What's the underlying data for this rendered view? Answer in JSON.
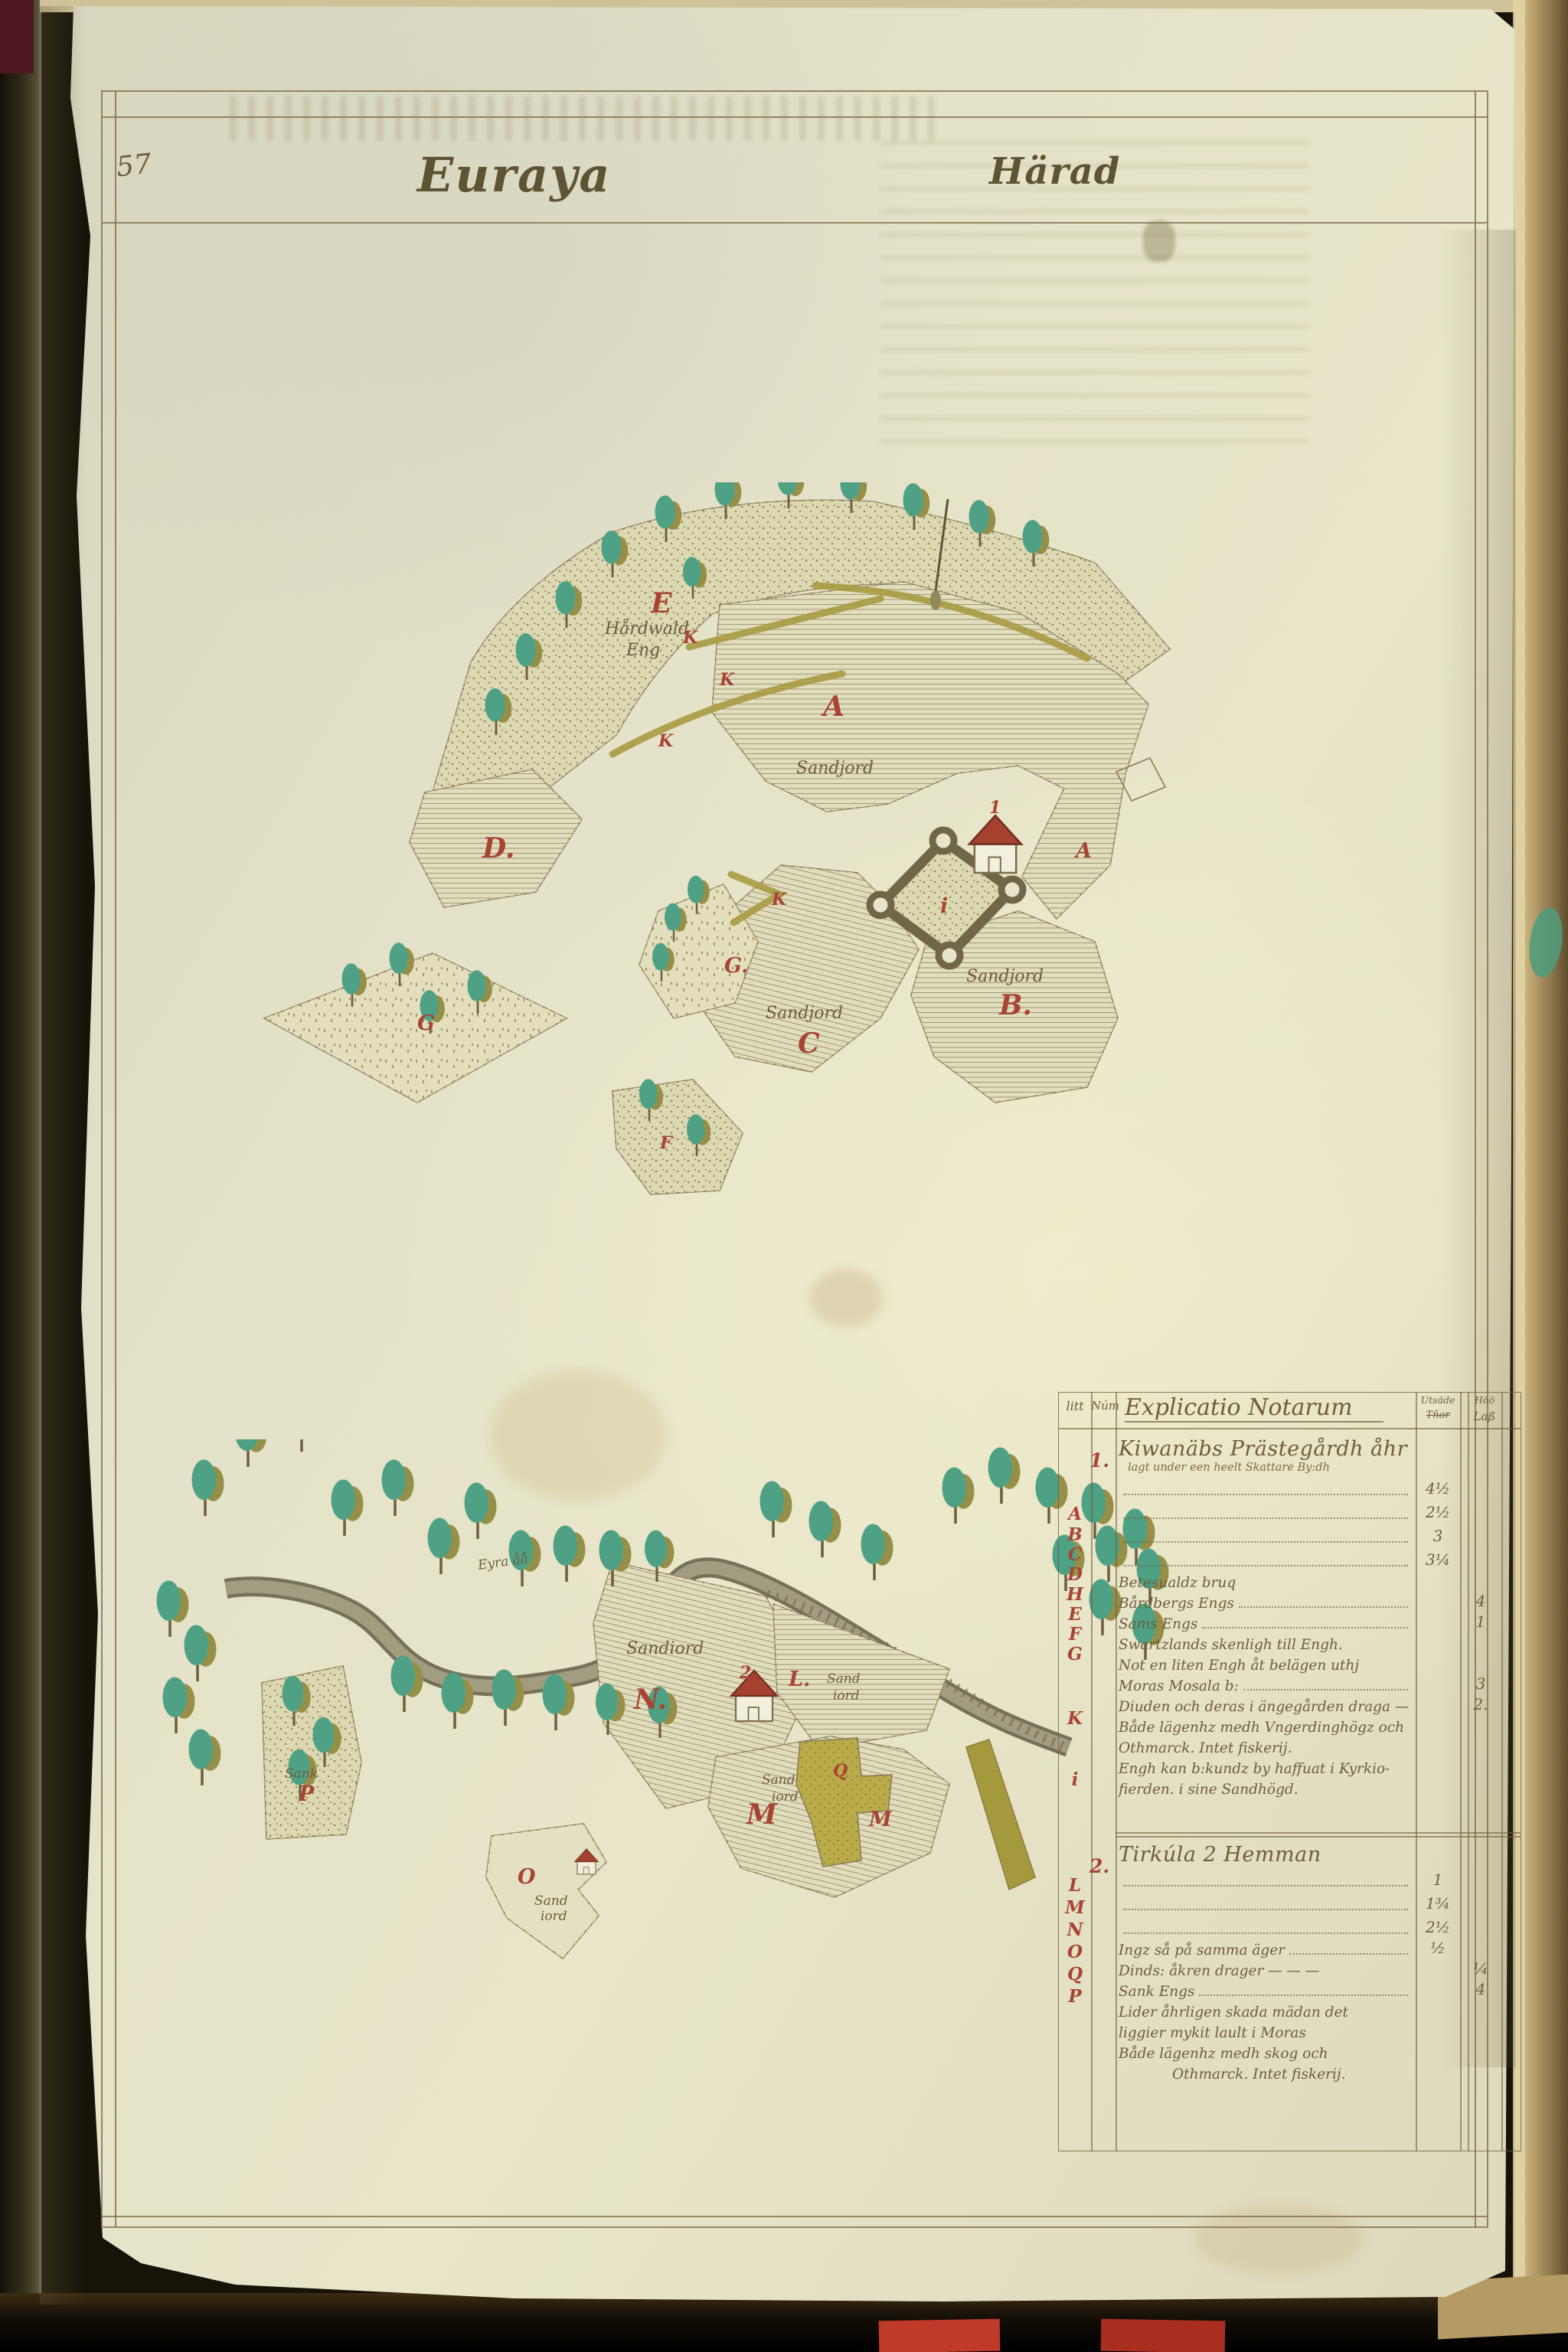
{
  "page": {
    "number": "57",
    "title_left": "Euraya",
    "title_right": "Härad"
  },
  "upper_map": {
    "letters": {
      "E": "E",
      "K1": "K",
      "K2": "K",
      "K3": "K",
      "K4": "K",
      "A": "A",
      "A2": "A",
      "D": "D.",
      "G_island": "G",
      "G_small": "G.",
      "C": "C",
      "B": "B.",
      "F": "F",
      "i": "i",
      "house_num": "1"
    },
    "labels": {
      "meadow1": "Hårdwald",
      "meadow2": "Eng",
      "sandjord_a": "Sandjord",
      "sandjord_c": "Sandjord",
      "sandjord_b": "Sandjord"
    }
  },
  "lower_map": {
    "letters": {
      "N": "N.",
      "L": "L.",
      "M1": "M",
      "M2": "M",
      "Q": "Q",
      "O": "O",
      "P": "P",
      "house_num": "2"
    },
    "labels": {
      "river": "Eyra åå",
      "sandiord_n": "Sandiord",
      "sandiord_l1": "Sand",
      "sandiord_l2": "iord",
      "sandiord_m1": "Sand",
      "sandiord_m2": "iord",
      "sandiord_o1": "Sand",
      "sandiord_o2": "iord",
      "sank_p": "Sank"
    }
  },
  "table": {
    "headers": {
      "litt": "litt",
      "num": "Núm",
      "explicatio": "Explicatio Notarum",
      "col1a": "Utsäde",
      "col1b": "Tñor",
      "col2a": "Höö",
      "col2b": "Laß"
    },
    "litt_letters": [
      "A",
      "B",
      "C",
      "D",
      "H",
      "E",
      "F",
      "G",
      "K",
      "i",
      "L",
      "M",
      "N",
      "O",
      "Q",
      "P"
    ],
    "entries": [
      {
        "num": "1.",
        "title": "Kiwanäbs Prästegårdh åhr",
        "subtitle": "lagt under een heelt Skattare By:dh",
        "rows": [
          {
            "leader": "dots",
            "col1": "4½"
          },
          {
            "leader": "dots",
            "col1": "2½"
          },
          {
            "leader": "dots",
            "col1": "3"
          },
          {
            "leader": "dots",
            "col1": "3¼"
          },
          {
            "text": "Betesualdz bruq"
          },
          {
            "text": "Bårdbergs Engs",
            "leader": "dots",
            "col2": "4"
          },
          {
            "text": "Sams Engs",
            "leader": "dots",
            "col2": "1"
          },
          {
            "text": "Swartzlands skenligh till Engh."
          },
          {
            "text": "Not en liten Engh åt belägen uthj"
          },
          {
            "text": "Moras Mosala b:",
            "leader": "dots",
            "col2": "3"
          },
          {
            "text": "Diuden och deras i ängegården draga —",
            "col2": "2."
          },
          {
            "text": "Både lägenhz medh Vngerdinghögz och"
          },
          {
            "text": "Othmarck. Intet fiskerij."
          },
          {
            "text": "Engh kan b:kundz by haffuat i Kyrkio-"
          },
          {
            "text": "fierden. i sine Sandhögd."
          }
        ]
      },
      {
        "num": "2.",
        "title": "Tirkúla 2 Hemman",
        "rows": [
          {
            "leader": "dots",
            "col1": "1"
          },
          {
            "leader": "dots",
            "col1": "1¾"
          },
          {
            "leader": "dots",
            "col1": "2½"
          },
          {
            "text": "Ingz så på samma äger",
            "leader": "dots",
            "col1": "½"
          },
          {
            "text": "Dinds: åkren drager — — —",
            "col2": "¼"
          },
          {
            "text": "Sank Engs",
            "leader": "dots",
            "col2": "4"
          },
          {
            "text": "Lider åhrligen skada mädan det"
          },
          {
            "text": "liggier mykit lault i Moras"
          },
          {
            "text": "Både lägenhz medh skog och"
          },
          {
            "text": "Othmarck. Intet fiskerij.",
            "indent": true
          }
        ]
      }
    ]
  }
}
